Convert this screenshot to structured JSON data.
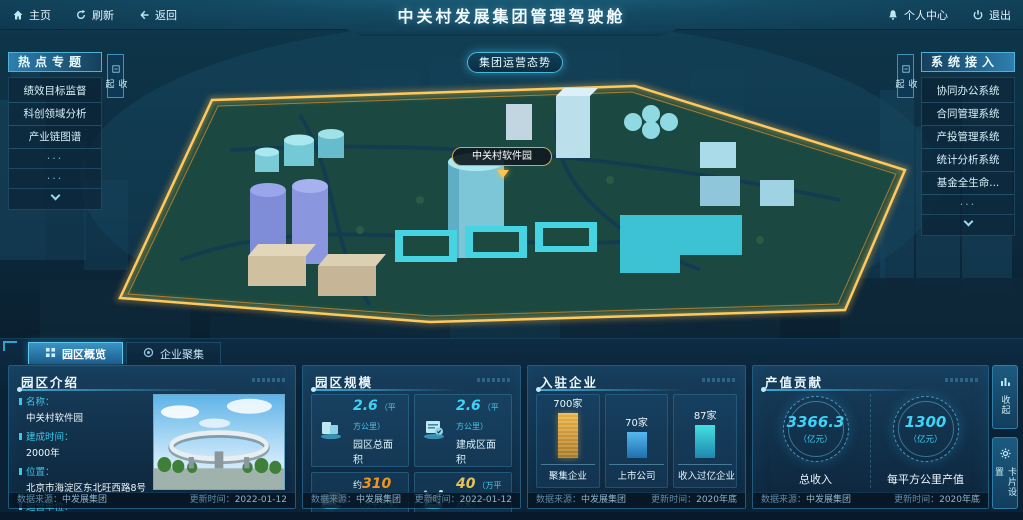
{
  "topbar": {
    "home": "主页",
    "refresh": "刷新",
    "back": "返回",
    "title": "中关村发展集团管理驾驶舱",
    "personal_center": "个人中心",
    "logout": "退出"
  },
  "scene": {
    "overview_button": "集团运营态势",
    "park_tag": "中关村软件园"
  },
  "hot_topics": {
    "title": "热点专题",
    "collapse": "收起",
    "more": "···",
    "items": [
      "绩效目标监督",
      "科创领域分析",
      "产业链图谱"
    ]
  },
  "systems": {
    "title": "系统接入",
    "collapse": "收起",
    "more": "···",
    "items": [
      "协同办公系统",
      "合同管理系统",
      "产投管理系统",
      "统计分析系统",
      "基金全生命..."
    ]
  },
  "tabs": {
    "park_overview": "园区概览",
    "enterprise_cluster": "企业聚集"
  },
  "panel_intro": {
    "title": "园区介绍",
    "fields": [
      {
        "label": "名称：",
        "value": "中关村软件园"
      },
      {
        "label": "建成时间：",
        "value": "2000年"
      },
      {
        "label": "位置：",
        "value": "北京市海淀区东北旺西路8号"
      },
      {
        "label": "运营单位：",
        "value": "北京中关村软件园发展有限公司"
      }
    ],
    "source_label": "数据来源：",
    "source": "中发展集团",
    "update_label": "更新时间：",
    "update": "2022-01-12"
  },
  "panel_scale": {
    "title": "园区规模",
    "cards": [
      {
        "prefix": "",
        "value": "2.6",
        "unit": "（平方公里）",
        "label": "园区总面积"
      },
      {
        "prefix": "",
        "value": "2.6",
        "unit": "（平方公里）",
        "label": "建成区面积"
      },
      {
        "prefix": "约",
        "value": "310",
        "unit": "（万平方米）",
        "label": "载体面积"
      },
      {
        "prefix": "",
        "value": "40",
        "unit": "（万平方米）",
        "label": "自持面积"
      }
    ],
    "source_label": "数据来源：",
    "source": "中发展集团",
    "update_label": "更新时间：",
    "update": "2022-01-12"
  },
  "panel_enterprises": {
    "title": "入驻企业",
    "bars": [
      {
        "value_label": "700家",
        "label": "聚集企业"
      },
      {
        "value_label": "70家",
        "label": "上市公司"
      },
      {
        "value_label": "87家",
        "label": "收入过亿企业"
      }
    ],
    "source_label": "数据来源：",
    "source": "中发展集团",
    "update_label": "更新时间：",
    "update": "2020年底"
  },
  "panel_output": {
    "title": "产值贡献",
    "gauges": [
      {
        "value": "3366.3",
        "unit": "（亿元）",
        "label": "总收入"
      },
      {
        "value": "1300",
        "unit": "（亿元）",
        "label": "每平方公里产值"
      }
    ],
    "source_label": "数据来源：",
    "source": "中发展集团",
    "update_label": "更新时间：",
    "update": "2020年底"
  },
  "side_buttons": {
    "collapse": "收起",
    "card_settings": "卡片设置"
  },
  "colors": {
    "accent_cyan": "#35d0f0",
    "accent_orange": "#f5941d",
    "accent_gold": "#e9c257",
    "bar_gold": "#d89a33",
    "bar_blue": "#2f9ad8",
    "bar_cyan": "#31cfd4",
    "boundary_glow": "#ffb844"
  },
  "chart_data": [
    {
      "type": "bar",
      "title": "入驻企业",
      "categories": [
        "聚集企业",
        "上市公司",
        "收入过亿企业"
      ],
      "values": [
        700,
        70,
        87
      ],
      "unit": "家",
      "colors": [
        "#d89a33",
        "#2f9ad8",
        "#31cfd4"
      ],
      "note": "bar heights in source UI are not linearly scaled"
    },
    {
      "type": "gauge",
      "title": "产值贡献",
      "items": [
        {
          "label": "总收入",
          "value": 3366.3,
          "unit": "亿元"
        },
        {
          "label": "每平方公里产值",
          "value": 1300,
          "unit": "亿元"
        }
      ]
    },
    {
      "type": "table",
      "title": "园区规模",
      "rows": [
        [
          "园区总面积",
          "2.6",
          "平方公里"
        ],
        [
          "建成区面积",
          "2.6",
          "平方公里"
        ],
        [
          "载体面积",
          "约310",
          "万平方米"
        ],
        [
          "自持面积",
          "40",
          "万平方米"
        ]
      ]
    }
  ]
}
